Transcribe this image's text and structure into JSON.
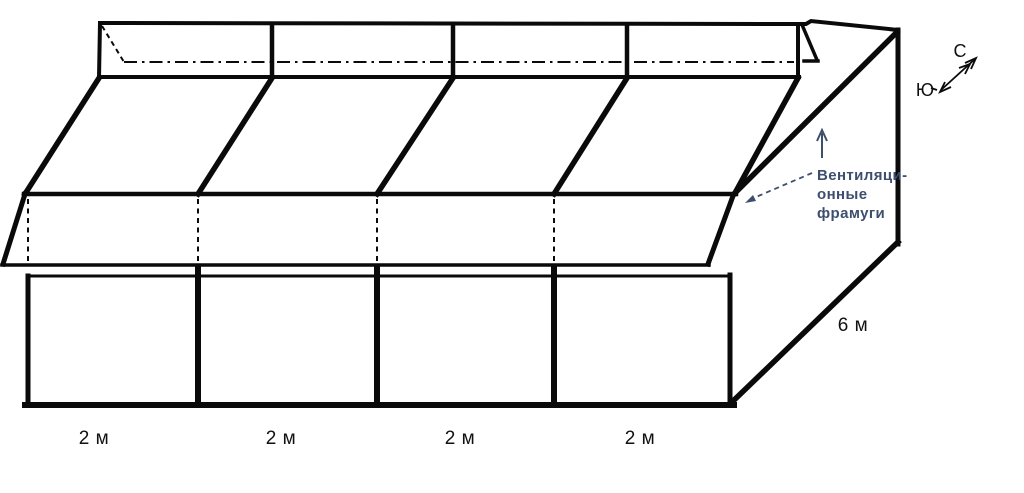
{
  "colors": {
    "line": "#0a0a0a",
    "annotation": "#3d4f6e",
    "background": "#ffffff"
  },
  "front_sections": {
    "labels": [
      "2 м",
      "2 м",
      "2 м",
      "2 м"
    ]
  },
  "depth": {
    "label": "6 м"
  },
  "vent_annotation": {
    "line1": "Вентиляци-",
    "line2": "онные",
    "line3": "фрамуги"
  },
  "compass": {
    "north_label": "С",
    "south_label": "Ю"
  }
}
